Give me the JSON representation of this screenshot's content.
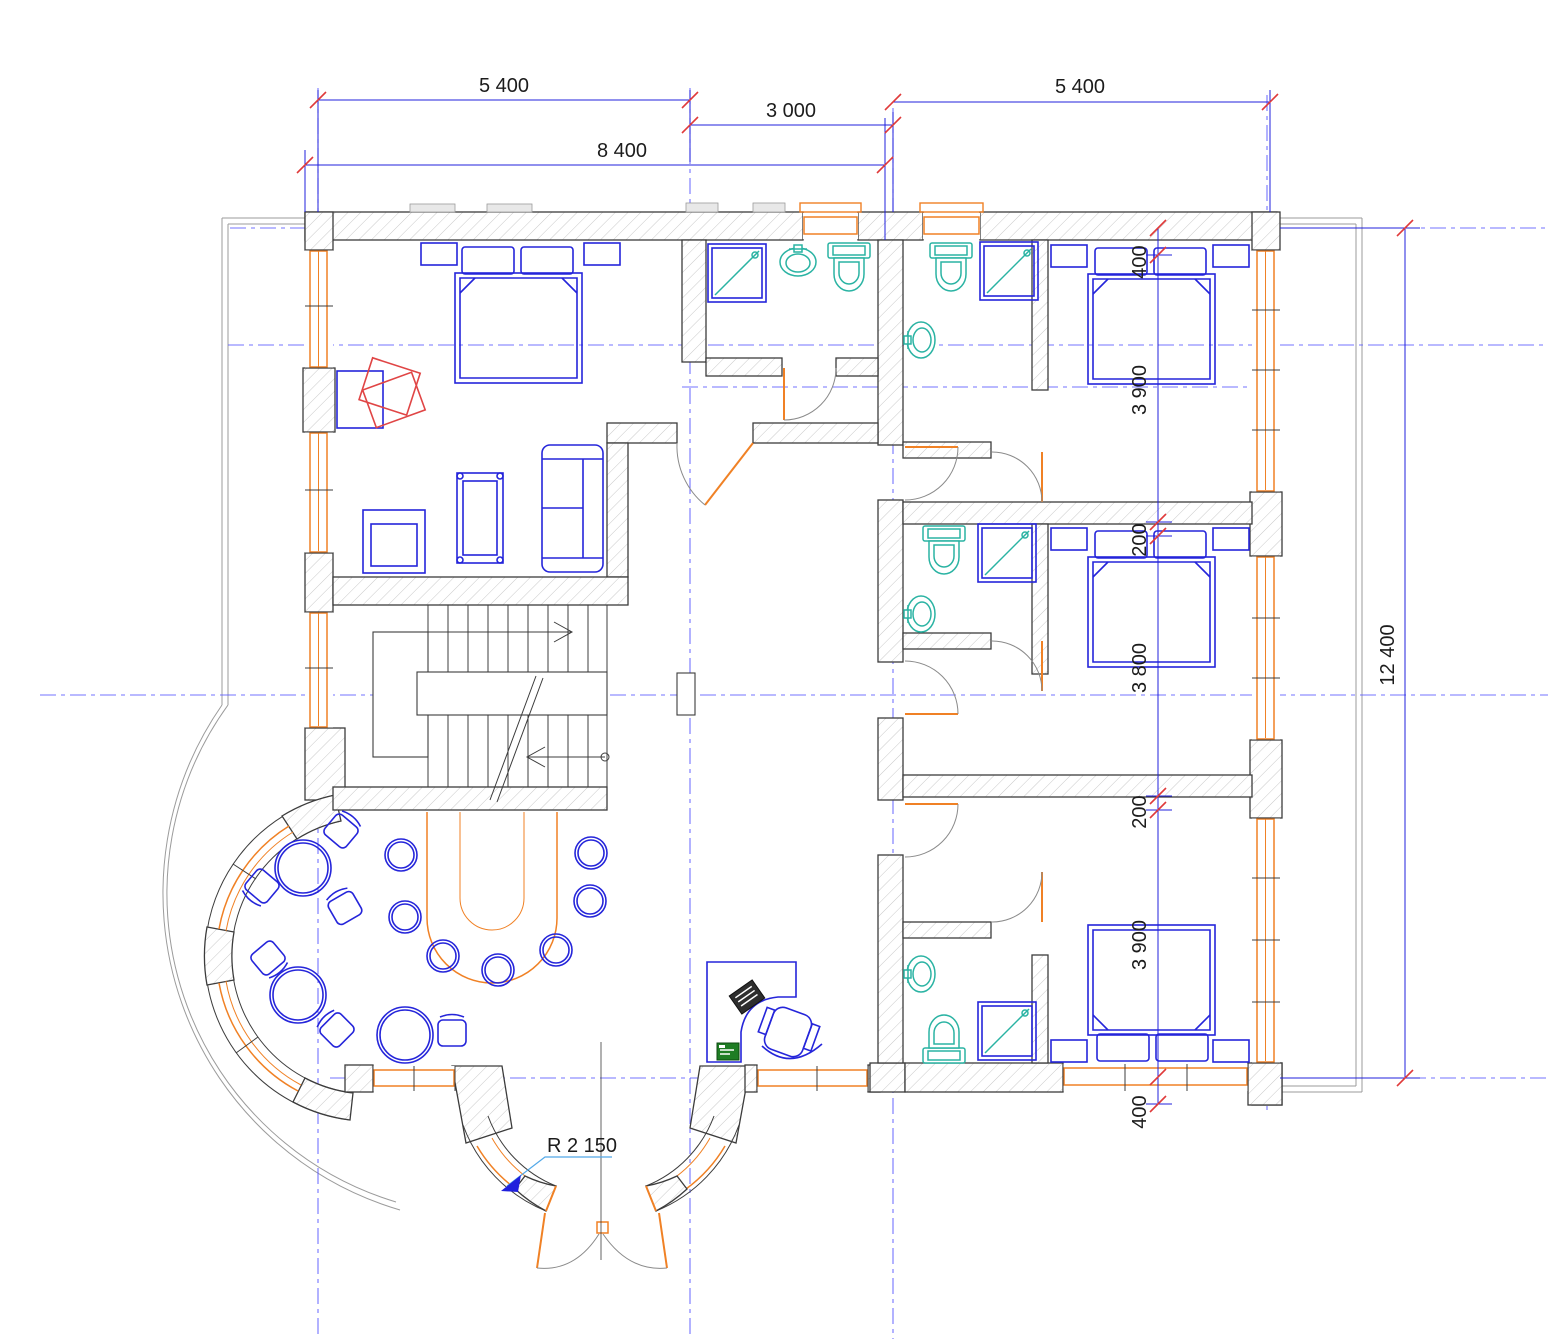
{
  "dimensions": {
    "top": {
      "width_left": "5 400",
      "width_center": "3 000",
      "width_total_left": "8 400",
      "width_right": "5 400"
    },
    "right_chain": [
      "400",
      "3 900",
      "200",
      "3 800",
      "200",
      "3 900",
      "400"
    ],
    "overall_depth": "12 400",
    "entrance_radius": "R 2 150"
  },
  "colors": {
    "wall-line": "#3c3c3c",
    "hatch": "#c9c9c9",
    "window": "#f08125",
    "furniture": "#2525da",
    "sanitary": "#2ab3a3",
    "axis": "#5b5bff",
    "dim": "#2020dd",
    "tick": "#e03a3a",
    "leader": "#52a8e8",
    "terrace": "#9b9b9b",
    "accent-red": "#e04545",
    "accent-green": "#1f7d24",
    "text": "#1c1c1c",
    "stair": "#3c3c3c"
  }
}
